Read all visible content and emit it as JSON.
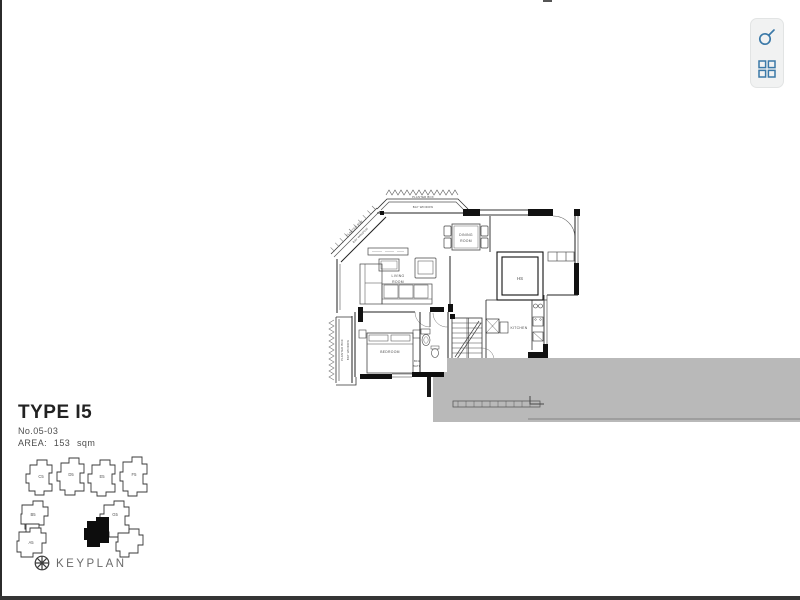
{
  "page": {
    "title": "TYPE I5",
    "unit_no": "No.05-03",
    "area_label": "AREA: 153 sqm"
  },
  "toolbar": {
    "icon_color": "#3b79a8",
    "buttons": [
      {
        "name": "zoom",
        "icon": "magnifier-icon"
      },
      {
        "name": "layout-grid",
        "icon": "grid-icon"
      }
    ]
  },
  "floorplan": {
    "rooms": {
      "living": {
        "line1": "LIVING",
        "line2": "ROOM"
      },
      "dining": {
        "line1": "DINING",
        "line2": "ROOM"
      },
      "bedroom": {
        "label": "BEDROOM"
      },
      "kitchen": {
        "label": "KITCHEN"
      },
      "household_shelter": {
        "label": "HS"
      },
      "bath": {
        "line1": "BFA",
        "line2": "BATH"
      }
    },
    "annotations": {
      "planter_box": "PLANTER BOX",
      "bay_window": "BAY WINDOW"
    },
    "colors": {
      "overlay_gray": "#b9b9b9",
      "line": "#1d1d1d"
    }
  },
  "keyplan": {
    "caption": "KEYPLAN",
    "blocks": {
      "c5": "C5",
      "d5": "D5",
      "e5": "E5",
      "f5": "F5",
      "b5": "B5",
      "a5": "A5",
      "g5": "G5"
    }
  }
}
